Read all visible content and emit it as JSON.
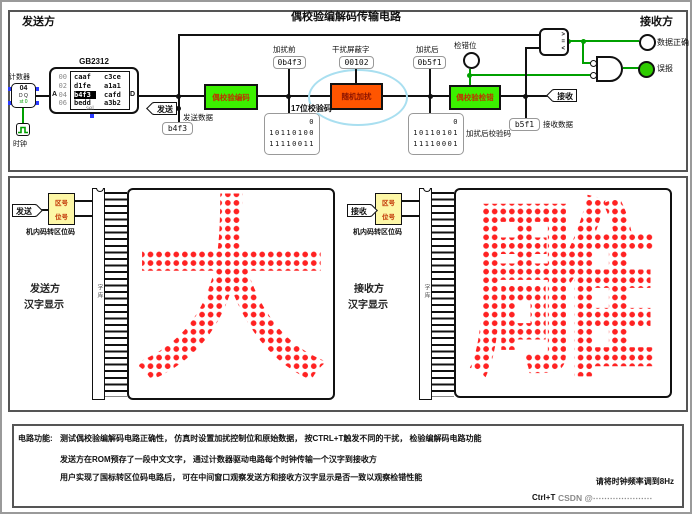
{
  "window": {
    "title": "偶校验编解码传输电路"
  },
  "top": {
    "sender": "发送方",
    "receiver": "接收方",
    "counter_label": "计数器",
    "counter_value": "04",
    "counter_dq": "D Q",
    "counter_st": "st 0",
    "clock_label": "时钟",
    "rom_title": "GB2312",
    "rom_pin_a": "A",
    "rom_pin_d": "D",
    "rom_pin_sel": "sel",
    "rom_addrs": [
      "00",
      "02",
      "04",
      "06"
    ],
    "rom_rows": [
      [
        "caaf",
        "c3ce"
      ],
      [
        "d1fe",
        "a1a1"
      ],
      [
        "b4f3",
        "cafd"
      ],
      [
        "bedd",
        "a3b2"
      ]
    ],
    "send_tag": "发送",
    "send_data_label": "发送数据",
    "send_data_value": "b4f3",
    "encoder": "偶校验编码",
    "probe_before_label": "加扰前",
    "probe_before_value": "0b4f3",
    "check17_label": "17位校验码",
    "check17_lines": [
      "0",
      "10110100",
      "11110011"
    ],
    "scrambler": "随机加扰",
    "mask_label": "干扰屏蔽字",
    "mask_value": "00102",
    "probe_after_label": "加扰后",
    "probe_after_value": "0b5f1",
    "check_after_label": "加扰后校验码",
    "check_after_lines": [
      "0",
      "10110101",
      "11110001"
    ],
    "errorbit_label": "检错位",
    "checker": "偶校验检错",
    "receive_tag": "接收",
    "receive_data_label": "接收数据",
    "receive_data_value": "b5f1",
    "comparator_gt": ">",
    "comparator_eq": "=",
    "comparator_lt": "<",
    "ok_label": "数据正确",
    "false_label": "误报"
  },
  "middle": {
    "left": {
      "tag": "发送",
      "conv_top": "区号",
      "conv_bottom": "位号",
      "conv_label": "机内码转区位码",
      "chip": "字库",
      "char": "大",
      "who": "发送方",
      "what": "汉字显示"
    },
    "right": {
      "tag": "接收",
      "conv_top": "区号",
      "conv_bottom": "位号",
      "conv_label": "机内码转区位码",
      "chip": "字库",
      "char": "雕",
      "who": "接收方",
      "what": "汉字显示"
    }
  },
  "bottom": {
    "prefix": "电路功能:",
    "lines": [
      "测试偶校验编解码电路正确性， 仿真时设置加扰控制位和原始数据， 按CTRL+T触发不同的干扰， 检验编解码电路功能",
      "发送方在ROM预存了一段中文文字， 通过计数器驱动电路每个时钟传输一个汉字到接收方",
      "用户实现了国标转区位码电路后， 可在中间窗口观察发送方和接收方汉字显示是否一致以观察检错性能"
    ],
    "clock_note": "请将时钟频率调到8Hz",
    "shortcut": "Ctrl+T",
    "watermark": "CSDN @⋯⋯⋯⋯⋯⋯⋯"
  },
  "colors": {
    "box_green": "#3cf000",
    "box_orange": "#ff5500",
    "dot_red": "#ff2222",
    "wire_green": "#00a000",
    "highlight_cyan": "#a9dff0",
    "converter_yellow": "#fdf7a6"
  }
}
